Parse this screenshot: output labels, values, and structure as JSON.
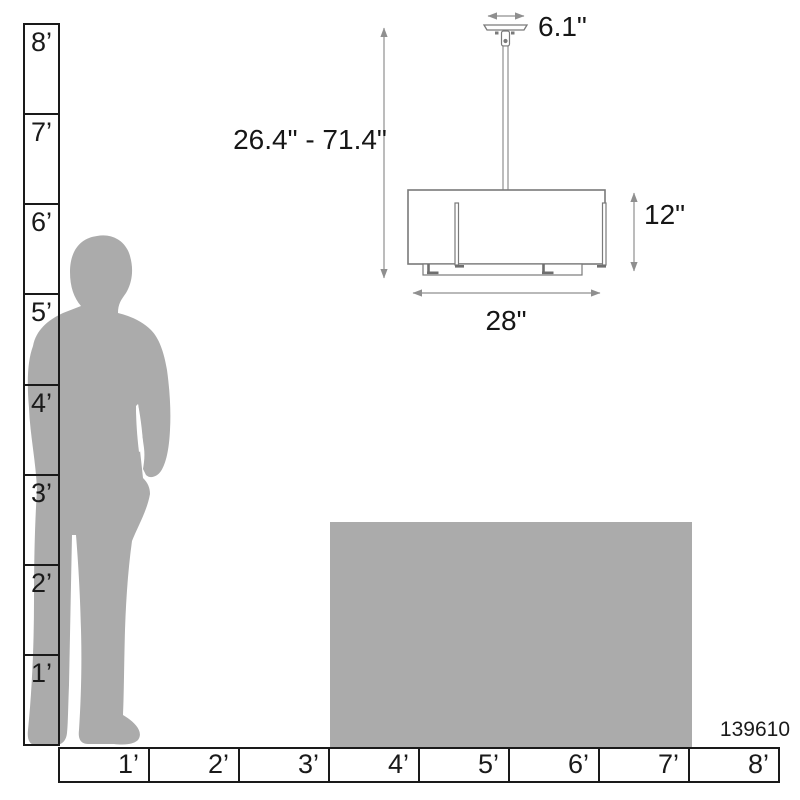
{
  "product_id": "139610",
  "fixture": {
    "name": "drum-pendant-light",
    "canopy_width": "6.1\"",
    "height_range": "26.4\" - 71.4\"",
    "shade_height": "12\"",
    "shade_width": "28\""
  },
  "rulers": {
    "vertical": {
      "unit": "feet",
      "labels": [
        "8’",
        "7’",
        "6’",
        "5’",
        "4’",
        "3’",
        "2’",
        "1’"
      ]
    },
    "horizontal": {
      "unit": "feet",
      "labels": [
        "1’",
        "2’",
        "3’",
        "4’",
        "5’",
        "6’",
        "7’",
        "8’"
      ]
    }
  },
  "colors": {
    "silhouette_gray": "#ABABAB",
    "table_gray": "#ABABAB",
    "ruler_line": "#1a1a1a",
    "fixture_line": "#7a7a7a",
    "dimension_line": "#8f8f8f",
    "text": "#161616"
  }
}
